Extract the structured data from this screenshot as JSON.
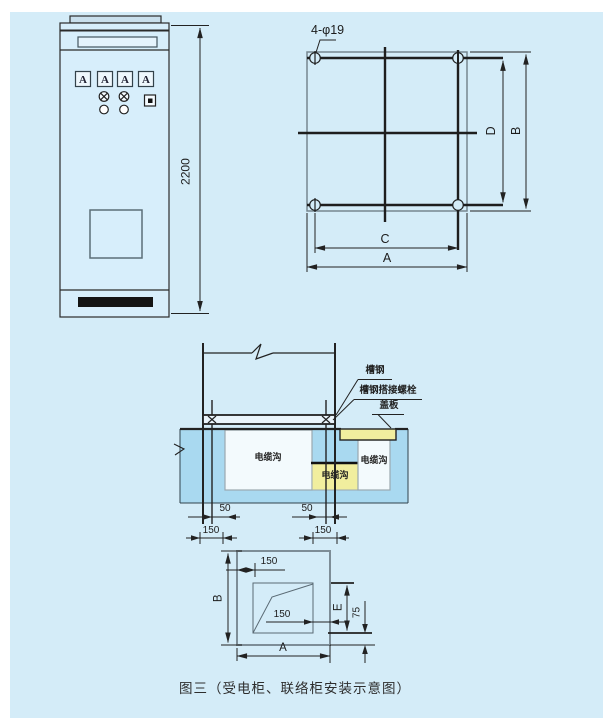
{
  "caption": "图三（受电柜、联络柜安装示意图）",
  "colors": {
    "panel_bg": "#d4ecf8",
    "concrete": "#a9d9f0",
    "trench": "#f3fafd",
    "cover_plate": "#f1ee9e",
    "grille": "#141414",
    "line": "#222222"
  },
  "front_view": {
    "height_dim": "2200",
    "meters": [
      "A",
      "A",
      "A",
      "A"
    ]
  },
  "plan_view": {
    "holes_label": "4-φ19",
    "dims": {
      "inner_vertical": "D",
      "outer_vertical": "B",
      "inner_horizontal": "C",
      "outer_horizontal": "A"
    }
  },
  "section_view": {
    "callouts": {
      "channel_steel": "槽钢",
      "channel_bolt": "槽钢搭接螺栓",
      "cover_plate": "盖板"
    },
    "trench_label": "电缆沟",
    "dims": {
      "left_offset": "50",
      "left_spacing": "150",
      "right_offset": "50",
      "right_spacing": "150"
    }
  },
  "bottom_plan": {
    "dims": {
      "top_margin": "150",
      "inner_margin": "150",
      "height": "B",
      "opening_height": "E",
      "edge_margin": "75",
      "width": "A"
    }
  }
}
